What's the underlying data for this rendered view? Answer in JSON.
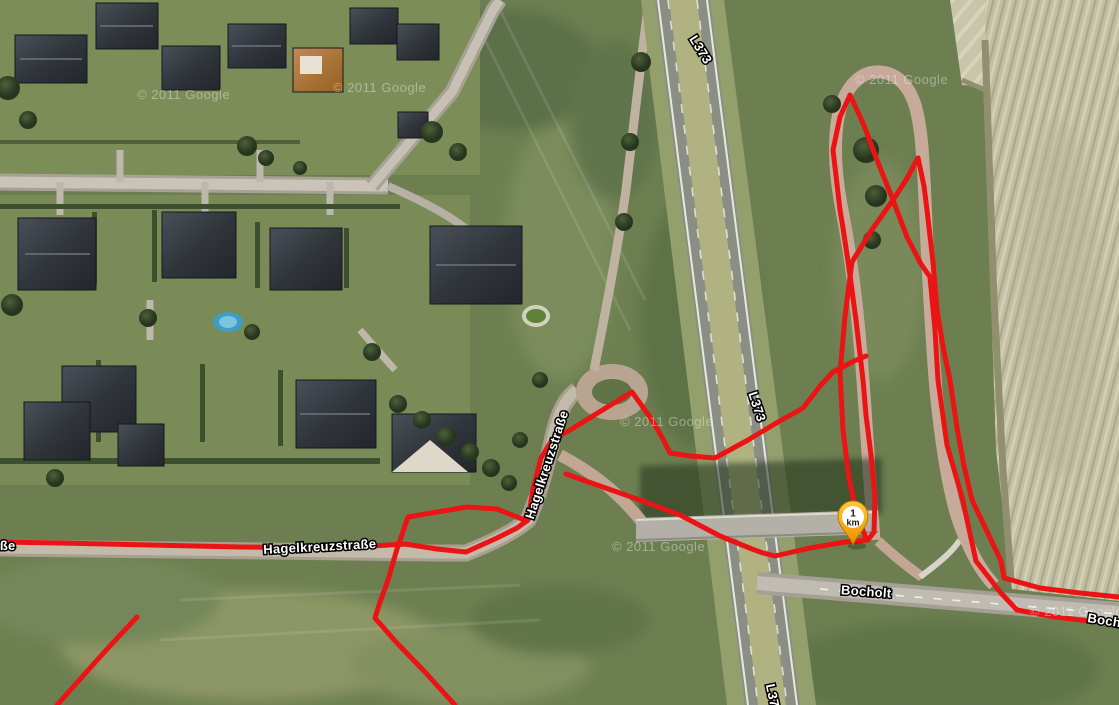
{
  "map": {
    "view": "satellite",
    "marker": {
      "label_top": "1",
      "label_bottom": "km",
      "x": 853,
      "y": 545,
      "color": "#f6a21a"
    },
    "road_labels": [
      {
        "id": "hagelkreuzstrasse-horizontal",
        "text": "Hagelkreuzstraße",
        "x": 320,
        "y": 551,
        "rotate": -3
      },
      {
        "id": "hagelkreuzstrasse-vertical",
        "text": "Hagelkreuzstraße",
        "x": 551,
        "y": 466,
        "rotate": -72
      },
      {
        "id": "l373-top",
        "text": "L373",
        "x": 697,
        "y": 52,
        "rotate": 58
      },
      {
        "id": "l373-middle",
        "text": "L373",
        "x": 753,
        "y": 408,
        "rotate": 72
      },
      {
        "id": "l373-bottom",
        "text": "L373",
        "x": 769,
        "y": 700,
        "rotate": 78
      },
      {
        "id": "bocholt",
        "text": "Bocholt",
        "x": 866,
        "y": 596,
        "rotate": 4
      },
      {
        "id": "bocholt-right",
        "text": "Bocholt",
        "x": 1112,
        "y": 626,
        "rotate": 9
      },
      {
        "id": "strasse-cut-left",
        "text": "Hagelkreuzstraße",
        "x": -41,
        "y": 550,
        "rotate": 0
      }
    ],
    "watermarks": {
      "text": "© 2011 Google",
      "positions": [
        [
          137,
          99
        ],
        [
          333,
          92
        ],
        [
          855,
          84
        ],
        [
          620,
          426
        ],
        [
          612,
          551
        ],
        [
          1030,
          616
        ]
      ]
    },
    "gps_track": {
      "color": "#ea1414",
      "stroke_width": 5,
      "polylines": [
        [
          [
            0,
            542
          ],
          [
            60,
            543
          ],
          [
            150,
            545
          ],
          [
            240,
            547
          ],
          [
            330,
            548
          ],
          [
            372,
            546
          ],
          [
            405,
            544
          ],
          [
            437,
            549
          ],
          [
            466,
            552
          ],
          [
            497,
            538
          ],
          [
            517,
            528
          ],
          [
            528,
            520
          ],
          [
            533,
            489
          ],
          [
            541,
            458
          ],
          [
            552,
            440
          ],
          [
            570,
            430
          ],
          [
            596,
            414
          ],
          [
            632,
            392
          ],
          [
            650,
            417
          ],
          [
            662,
            437
          ],
          [
            670,
            453
          ],
          [
            690,
            456
          ],
          [
            715,
            458
          ],
          [
            748,
            440
          ],
          [
            778,
            422
          ],
          [
            803,
            408
          ],
          [
            820,
            386
          ],
          [
            833,
            372
          ],
          [
            852,
            362
          ],
          [
            866,
            356
          ]
        ],
        [
          [
            566,
            474
          ],
          [
            600,
            486
          ],
          [
            640,
            500
          ],
          [
            680,
            515
          ],
          [
            720,
            536
          ],
          [
            752,
            549
          ],
          [
            763,
            553
          ],
          [
            775,
            556
          ],
          [
            810,
            548
          ],
          [
            845,
            542
          ],
          [
            868,
            540
          ],
          [
            874,
            532
          ],
          [
            875,
            498
          ],
          [
            871,
            455
          ],
          [
            866,
            415
          ],
          [
            863,
            380
          ],
          [
            856,
            320
          ],
          [
            849,
            268
          ],
          [
            843,
            228
          ],
          [
            840,
            210
          ],
          [
            833,
            150
          ],
          [
            840,
            117
          ],
          [
            850,
            95
          ],
          [
            863,
            123
          ],
          [
            877,
            160
          ],
          [
            893,
            200
          ],
          [
            907,
            237
          ],
          [
            921,
            264
          ],
          [
            930,
            277
          ],
          [
            935,
            330
          ],
          [
            938,
            380
          ],
          [
            947,
            445
          ],
          [
            962,
            497
          ],
          [
            976,
            561
          ],
          [
            1001,
            593
          ],
          [
            1017,
            610
          ],
          [
            1055,
            617
          ],
          [
            1090,
            621
          ],
          [
            1119,
            624
          ]
        ],
        [
          [
            866,
            538
          ],
          [
            857,
            516
          ],
          [
            849,
            478
          ],
          [
            843,
            430
          ],
          [
            840,
            373
          ],
          [
            845,
            316
          ],
          [
            852,
            262
          ],
          [
            871,
            231
          ],
          [
            893,
            200
          ],
          [
            906,
            180
          ],
          [
            918,
            158
          ]
        ],
        [
          [
            918,
            158
          ],
          [
            924,
            186
          ],
          [
            927,
            210
          ],
          [
            933,
            262
          ],
          [
            937,
            310
          ],
          [
            944,
            352
          ],
          [
            950,
            380
          ],
          [
            957,
            428
          ],
          [
            964,
            466
          ],
          [
            972,
            500
          ],
          [
            1001,
            561
          ],
          [
            1004,
            578
          ],
          [
            1040,
            588
          ],
          [
            1080,
            593
          ],
          [
            1119,
            597
          ]
        ],
        [
          [
            527,
            521
          ],
          [
            497,
            509
          ],
          [
            467,
            507
          ],
          [
            437,
            512
          ],
          [
            408,
            517
          ],
          [
            397,
            549
          ],
          [
            388,
            580
          ],
          [
            379,
            605
          ],
          [
            375,
            618
          ],
          [
            396,
            642
          ],
          [
            424,
            671
          ],
          [
            455,
            705
          ]
        ],
        [
          [
            57,
            705
          ],
          [
            82,
            677
          ],
          [
            108,
            648
          ],
          [
            137,
            617
          ]
        ]
      ]
    }
  }
}
